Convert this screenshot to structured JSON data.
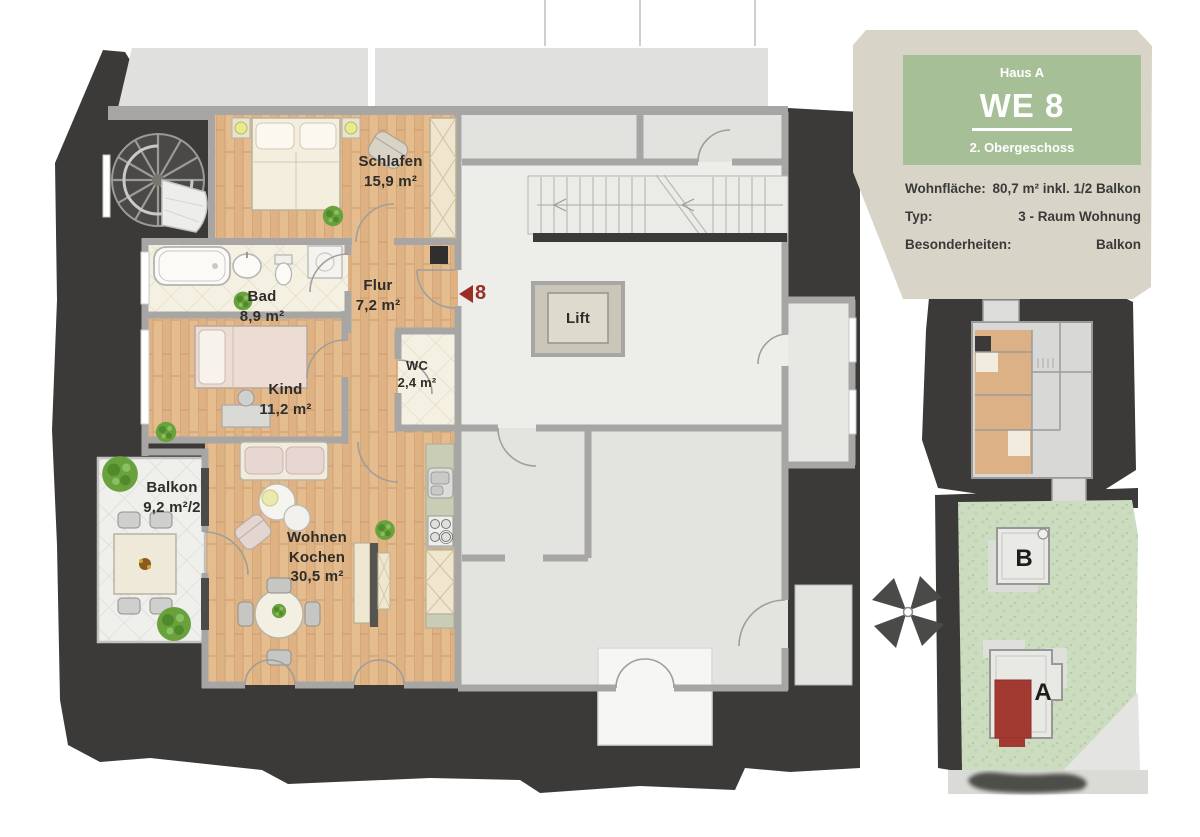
{
  "info_card": {
    "building": "Haus A",
    "unit": "WE 8",
    "floor": "2. Obergeschoss",
    "rows": [
      {
        "label": "Wohnfläche:",
        "value": "80,7 m² inkl. 1/2 Balkon"
      },
      {
        "label": "Typ:",
        "value": "3 - Raum Wohnung"
      },
      {
        "label": "Besonderheiten:",
        "value": "Balkon"
      }
    ]
  },
  "floorplan": {
    "unit_marker": "8",
    "lift_label": "Lift",
    "rooms": {
      "schlafen": {
        "name": "Schlafen",
        "area": "15,9 m²"
      },
      "bad": {
        "name": "Bad",
        "area": "8,9 m²"
      },
      "flur": {
        "name": "Flur",
        "area": "7,2 m²"
      },
      "kind": {
        "name": "Kind",
        "area": "11,2 m²"
      },
      "wc": {
        "name": "WC",
        "area": "2,4 m²"
      },
      "balkon": {
        "name": "Balkon",
        "area": "9,2 m²/2"
      },
      "wohnen_kochen": {
        "name_line1": "Wohnen",
        "name_line2": "Kochen",
        "area": "30,5 m²"
      }
    }
  },
  "site_plan": {
    "building_a": "A",
    "building_b": "B"
  },
  "colors": {
    "dark_background": "#3b3a39",
    "info_green": "#a6bf97",
    "panel_beige": "#d8d5c8",
    "unit_red": "#9b2c26",
    "site_unit_red": "#a33a32",
    "wood_floor": "#e2b88c",
    "grass_green": "#ccdcbf",
    "wall_gray": "#a7a6a4"
  }
}
